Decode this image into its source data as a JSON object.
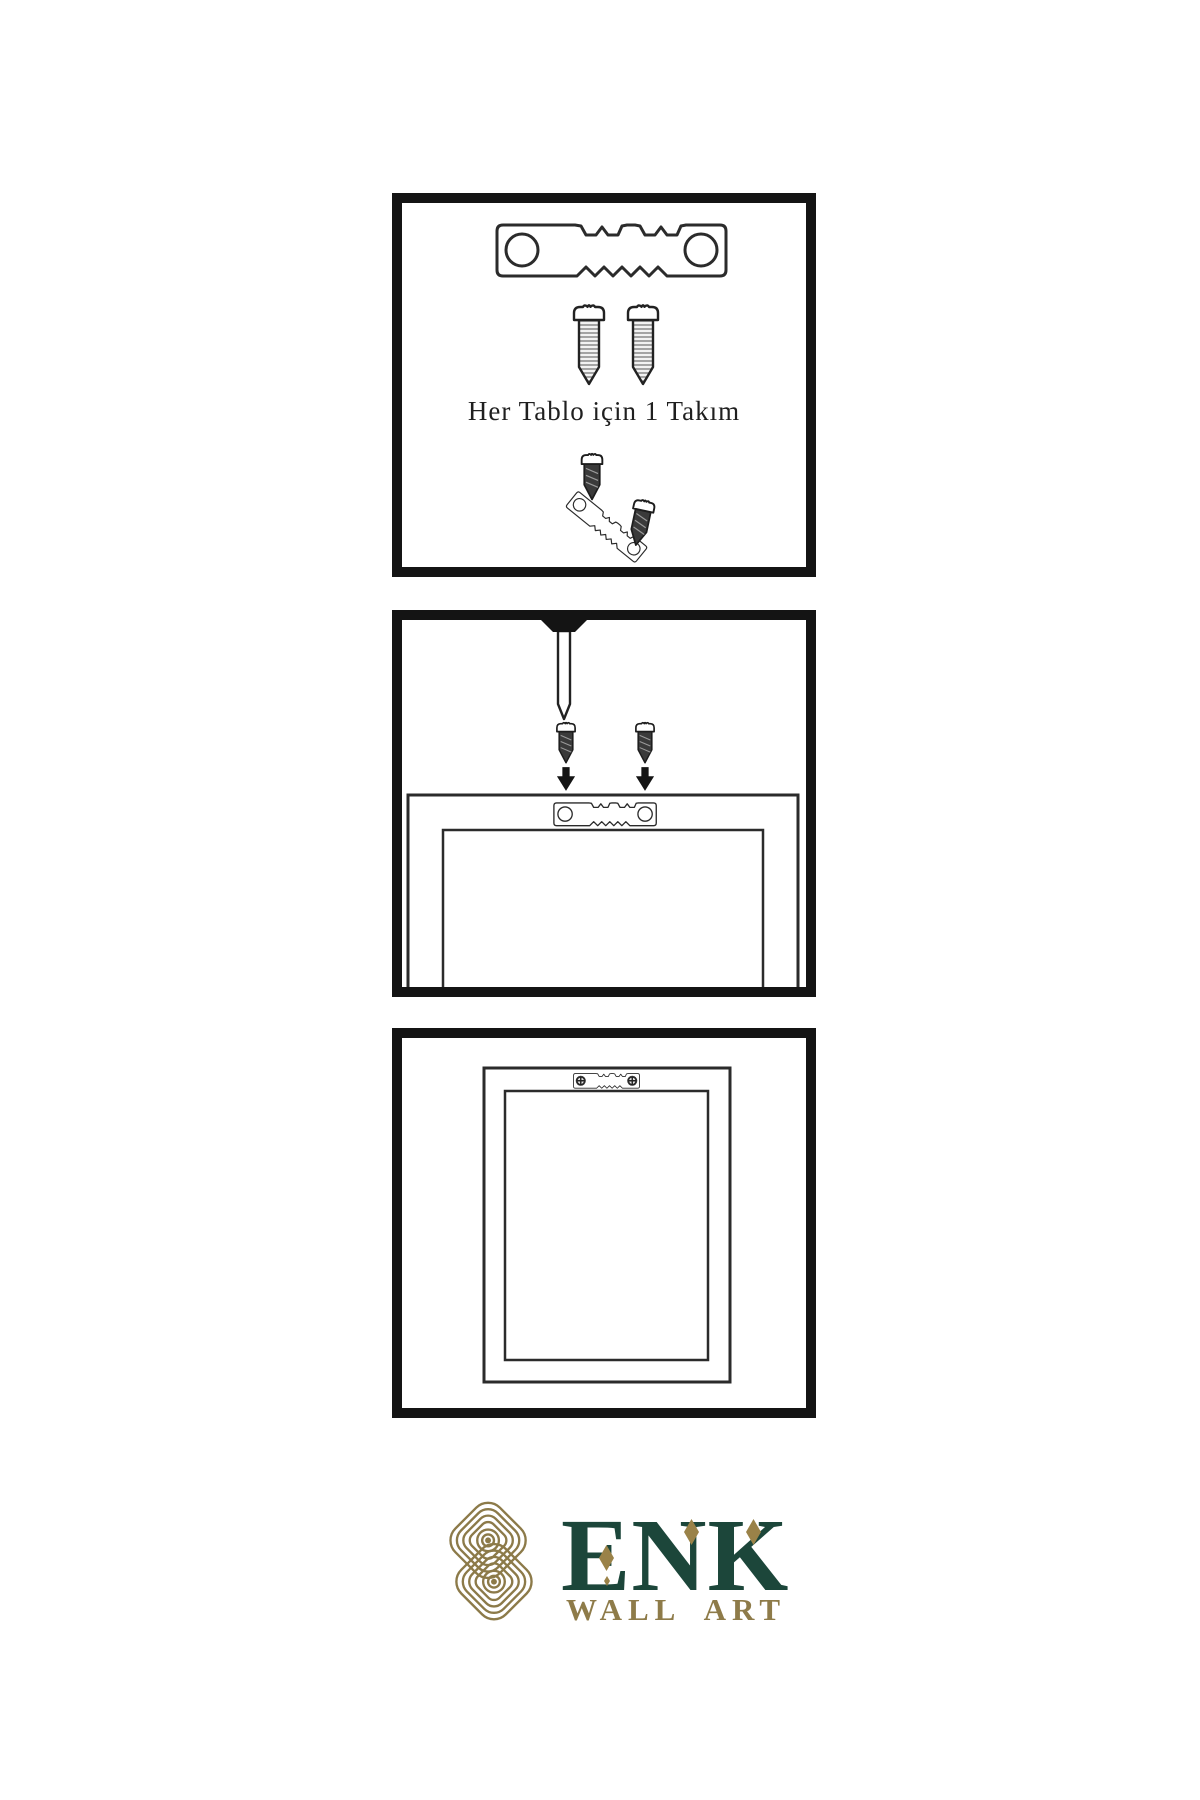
{
  "page": {
    "background": "#ffffff",
    "type": "wall-art hanging instruction sheet"
  },
  "colors": {
    "panel_border": "#141414",
    "line": "#2b2b2b",
    "dark_fill": "#3a3a3a",
    "brand_green": "#1c463a",
    "brand_gold": "#8e7b49",
    "brand_gold2": "#9a8248"
  },
  "step1": {
    "caption": "Her Tablo için 1 Takım",
    "illustrations": [
      "sawtooth-hanger",
      "screw",
      "screw",
      "dark-screw",
      "tilted-sawtooth-hanger",
      "dark-screw"
    ]
  },
  "step2": {
    "illustrations": [
      "wall-nail",
      "dark-screw",
      "dark-screw",
      "arrow-down",
      "arrow-down",
      "frame-back",
      "sawtooth-hanger"
    ]
  },
  "step3": {
    "illustrations": [
      "hanging-frame",
      "mounted-sawtooth-hanger"
    ]
  },
  "brand": {
    "name": "ENK",
    "subtitle": "WALL ART"
  }
}
